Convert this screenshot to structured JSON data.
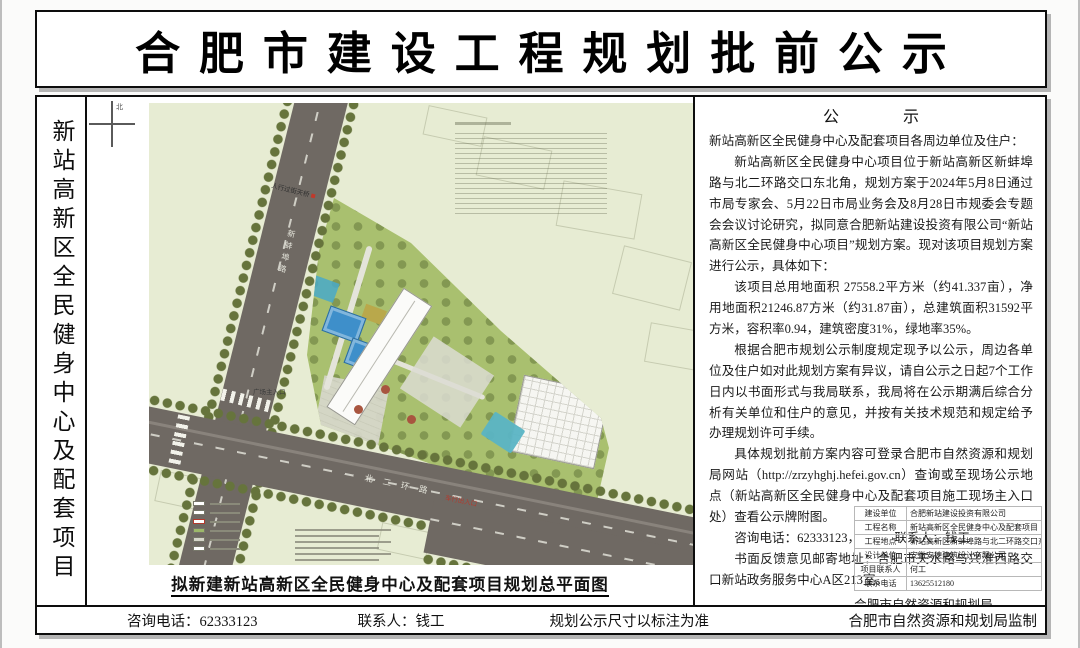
{
  "page": {
    "title": "合肥市建设工程规划批前公示",
    "side_label": "新站高新区全民健身中心及配套项目"
  },
  "map": {
    "north": "北",
    "caption": "拟新建新站高新区全民健身中心及配套项目规划总平面图",
    "labels": {
      "pedestrian_bridge": "人行过街天桥",
      "road_vertical": "新蚌埠路",
      "road_horizontal": "北二环路",
      "plaza_entrance": "广场主入口",
      "vehicle_entrance": "车行出入口"
    }
  },
  "notice": {
    "title": "公　　　　示",
    "paragraphs": [
      "新站高新区全民健身中心及配套项目各周边单位及住户：",
      "新站高新区全民健身中心项目位于新站高新区新蚌埠路与北二环路交口东北角，规划方案于2024年5月8日通过市局专家会、5月22日市局业务会及8月28日市规委会专题会会议讨论研究，拟同意合肥新站建设投资有限公司“新站高新区全民健身中心项目”规划方案。现对该项目规划方案进行公示，具体如下：",
      "该项目总用地面积 27558.2平方米（约41.337亩），净用地面积21246.87方米（约31.87亩），总建筑面积31592平方米，容积率0.94，建筑密度31%，绿地率35%。",
      "根据合肥市规划公示制度规定现予以公示，周边各单位及住户如对此规划方案有异议，请自公示之日起7个工作日内以书面形式与我局联系，我局将在公示期满后综合分析有关单位和住户的意见，并按有关技术规范和规定给予办理规划许可手续。",
      "具体规划批前方案内容可登录合肥市自然资源和规划局网站（http://zrzyhghj.hefei.gov.cn）查询或至现场公示地点（新站高新区全民健身中心及配套项目施工现场主入口处）查看公示牌附图。"
    ],
    "phone": "咨询电话：62333123，",
    "contact": "联系人：钱工",
    "address": "书面反馈意见邮寄地址：合肥市天水路与兴淮西路交口新站政务服务中心A区213室。",
    "signature": "合肥市自然资源和规划局",
    "date": "二〇二四年十月二十四日"
  },
  "info_table": {
    "rows": [
      {
        "label": "建设单位",
        "value": "合肥新站建设投资有限公司"
      },
      {
        "label": "工程名称",
        "value": "新站高新区全民健身中心及配套项目"
      },
      {
        "label": "工程地点",
        "value": "新站高新区新蚌埠路与北二环路交口东北角"
      },
      {
        "label": "设计单位",
        "value": "安徽安德建筑设计有限公司"
      },
      {
        "label": "项目联系人",
        "value": "何工"
      },
      {
        "label": "联系电话",
        "value": "13625512180"
      }
    ]
  },
  "footer": {
    "phone": "咨询电话：62333123",
    "contact": "联系人：钱工",
    "note": "规划公示尺寸以标注为准",
    "producer": "合肥市自然资源和规划局监制"
  },
  "colors": {
    "plan_background": "#e7ecd3",
    "road": "#6f6963",
    "site_green": "#a9c06f",
    "tree_olive": "#66743c",
    "court_blue": "#3e8fca",
    "glass_teal": "#5ab4c4",
    "accent_red": "#b23a2e",
    "frame_black": "#0d0d0d",
    "shadow_grey": "#b5b5b5"
  }
}
